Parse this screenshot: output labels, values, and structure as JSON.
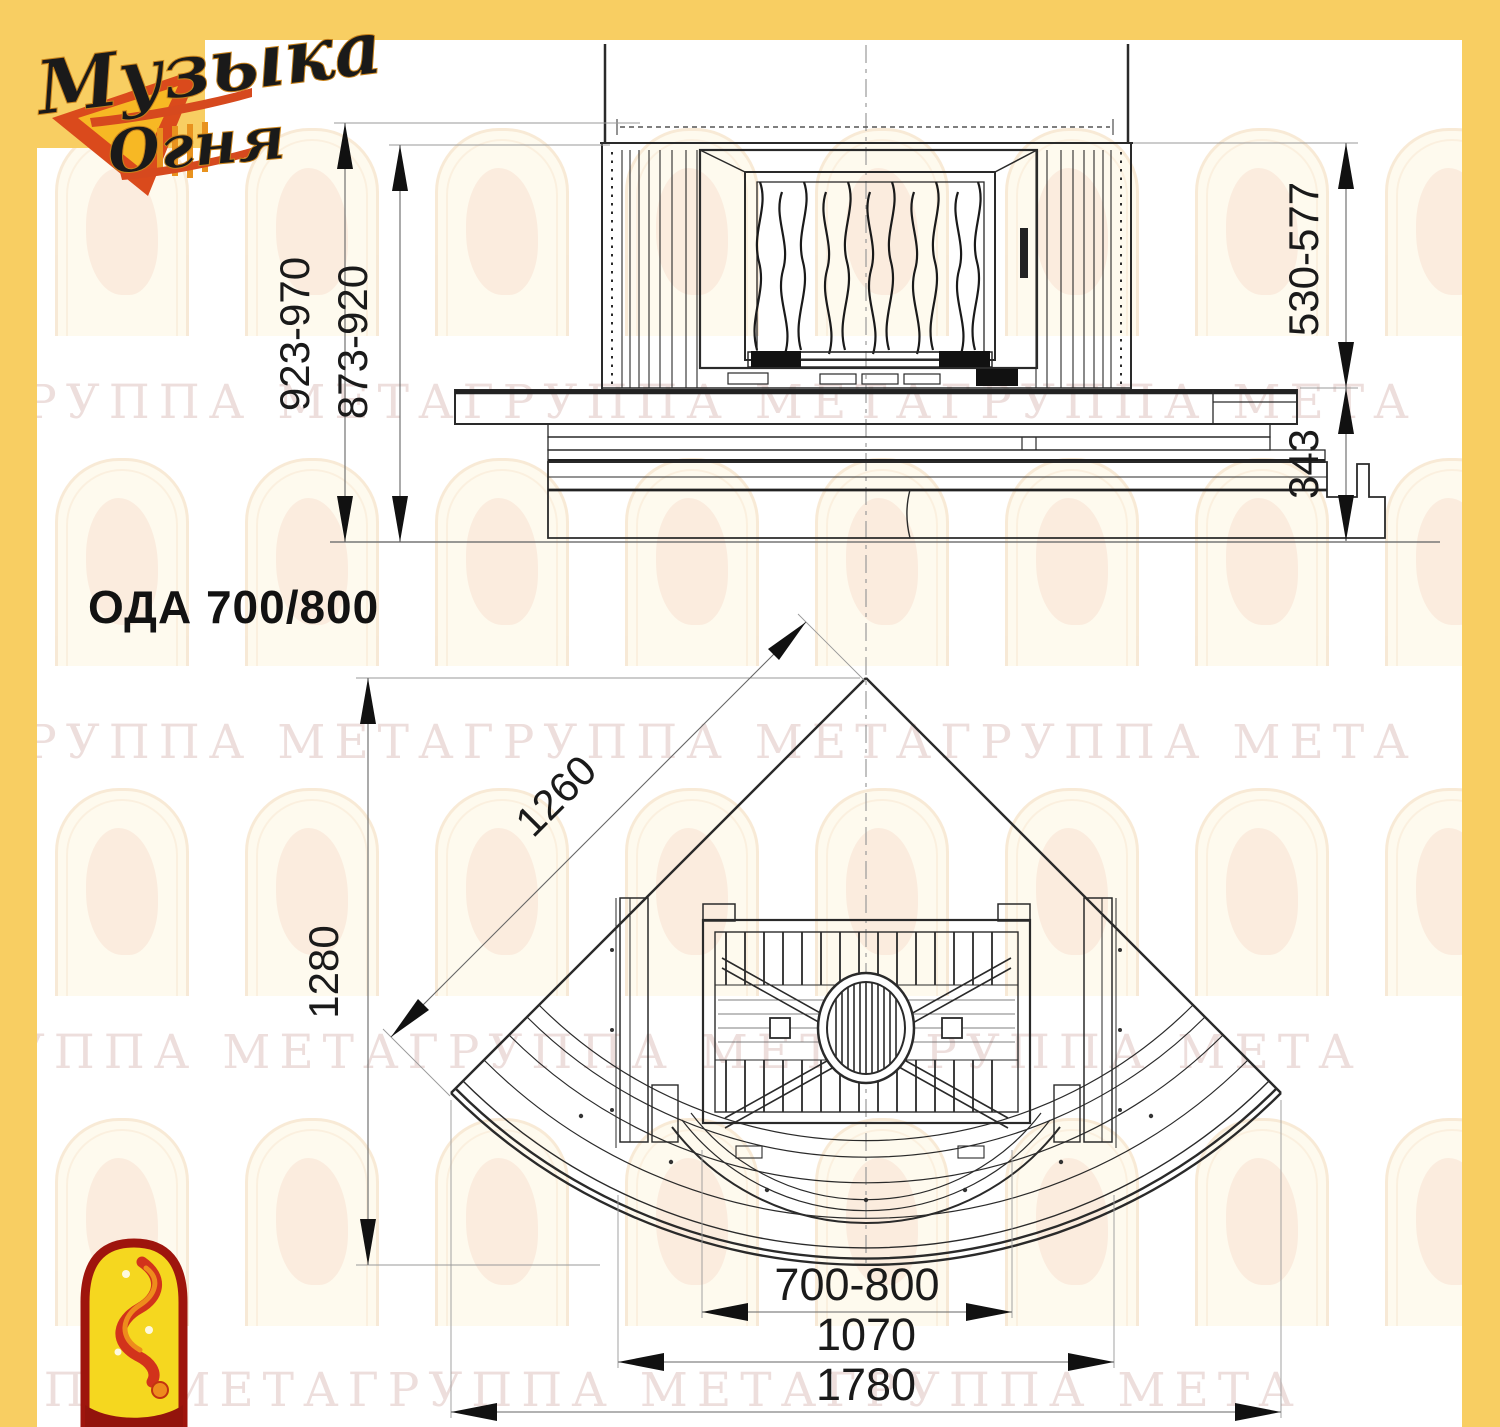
{
  "page": {
    "model_label": "ОДА 700/800"
  },
  "watermark": {
    "text": "ГРУППА МЕТАГРУППА МЕТАГРУППА МЕТА"
  },
  "brand": {
    "name_line1": "Музыка",
    "name_line2": "Огня"
  },
  "front_view": {
    "dims": {
      "height_overall": "923-970",
      "height_inner": "873-920",
      "firebox_height": "530-577",
      "plinth_height": "343"
    }
  },
  "plan_view": {
    "dims": {
      "side_diagonal": "1260",
      "depth": "1280",
      "portal_width": "700-800",
      "body_width": "1070",
      "overall_width": "1780"
    }
  },
  "colors": {
    "frame_yellow": "#F8CE62",
    "logo_red": "#D6491E",
    "logo_gold": "#EFB42F",
    "emblem_yellow": "#F5D71F",
    "emblem_dark_red": "#9E150D",
    "line_dark": "#222222"
  }
}
